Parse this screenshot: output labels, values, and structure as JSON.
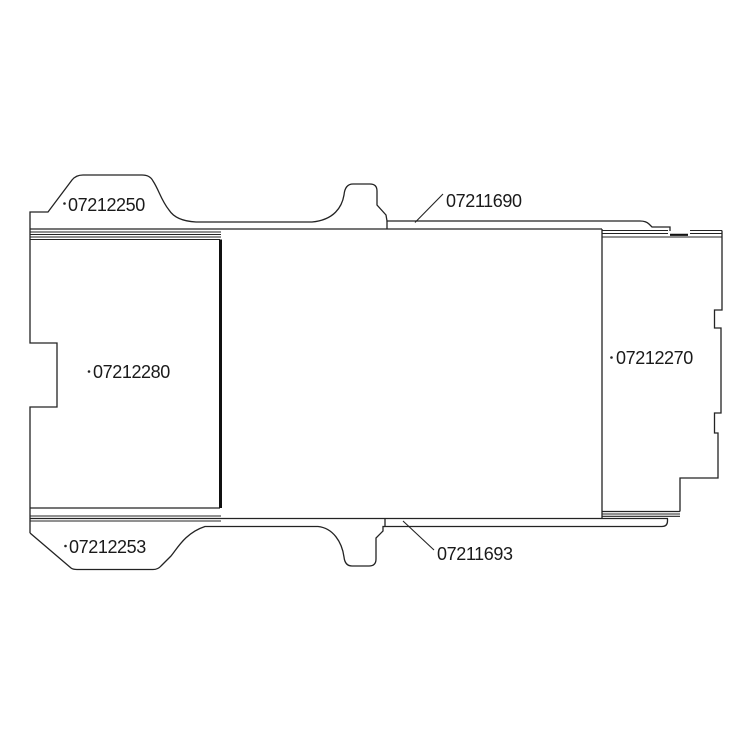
{
  "diagram_type": "technical-parts-drawing",
  "colors": {
    "background": "#ffffff",
    "line": "#232323",
    "divider_line": "#111111",
    "text": "#1a1a1a"
  },
  "labels": {
    "top_left": {
      "part": "07212250"
    },
    "top_right": {
      "part": "07211690"
    },
    "left_panel": {
      "part": "07212280"
    },
    "right_panel": {
      "part": "07212270"
    },
    "bottom_left": {
      "part": "07212253"
    },
    "bottom_right": {
      "part": "07211693"
    }
  }
}
